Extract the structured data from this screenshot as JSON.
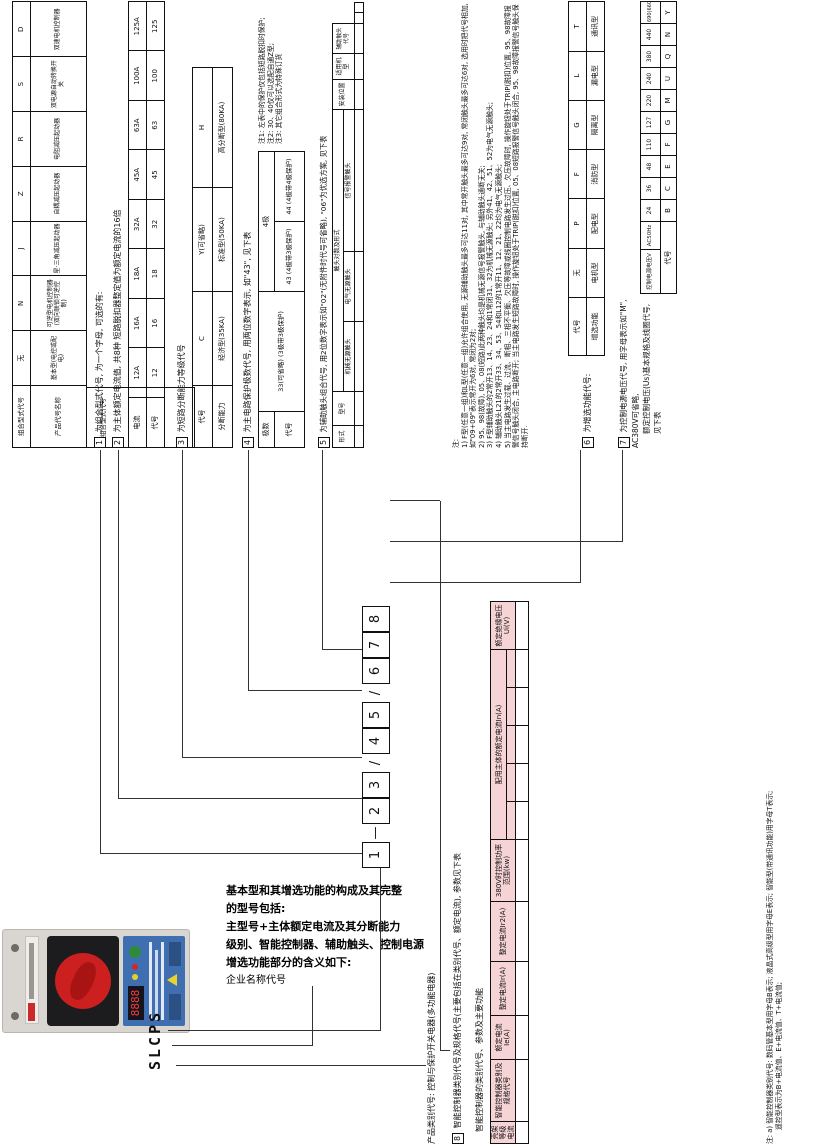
{
  "brand_model": "SLCPS",
  "intro": {
    "lines": [
      "基本型和其增选功能的构成及其完整",
      "的型号包括:",
      "主型号+主体额定电流及其分断能力",
      "级别、智能控制器、辅助触头、控制电源",
      "增选功能部分的含义如下:",
      "企业名称代号"
    ]
  },
  "model_row": {
    "items": [
      {
        "t": "1",
        "cls": "mbox"
      },
      {
        "t": "—",
        "cls": "msep"
      },
      {
        "t": "2",
        "cls": "mbox"
      },
      {
        "t": "3",
        "cls": "mbox"
      },
      {
        "t": "/",
        "cls": "msep"
      },
      {
        "t": "4",
        "cls": "mbox"
      },
      {
        "t": "5",
        "cls": "mbox"
      },
      {
        "t": "/",
        "cls": "msep"
      },
      {
        "t": "6",
        "cls": "mbox"
      },
      {
        "t": "7",
        "cls": "mbox"
      },
      {
        "t": "8",
        "cls": "mbox"
      }
    ]
  },
  "left_captions": {
    "product_class": "产品类别代号: 控制与保护开关电器(多功能电器)",
    "sec8_num": "8",
    "sec8_caption": "智能控制器类别代号及规格代号(主要包括在类别代号、额定电流), 参数见下表",
    "big_table_title": "智能控制器的类别代号、参数及主要功能"
  },
  "sections": {
    "s1": {
      "num": "1",
      "caption": "为组合型式代号, 为一个字母, 可选的有:",
      "row1_label": "组合型式代号",
      "row2_label": "产品代号名称",
      "codes": [
        "无",
        "N",
        "J",
        "Z",
        "R",
        "S",
        "D"
      ],
      "names": [
        "基本型(电控或配电)",
        "可逆型电机控制器(双向联锁可逆控制)",
        "星·三角减压起动器",
        "自耦减压起动器",
        "电阻减压起动器",
        "双电源自动转换开关",
        "双速电机控制器"
      ]
    },
    "s2": {
      "num": "2",
      "caption": "为主体额定电流值, 共8种 短路脱扣器整定值为额定电流的16倍",
      "row1_label": "电流",
      "row2_label": "代号",
      "currents": [
        "12A",
        "16A",
        "18A",
        "32A",
        "45A",
        "63A",
        "100A",
        "125A"
      ],
      "codes": [
        "12",
        "16",
        "18",
        "32",
        "45",
        "63",
        "100",
        "125"
      ]
    },
    "s3": {
      "num": "3",
      "caption": "为短路分断能力等级代号",
      "row1_label": "代号",
      "row2_label": "分断能力",
      "codes": [
        "C",
        "Y(可省略)",
        "H"
      ],
      "abilities": [
        "经济型(35KA)",
        "标准型(50KA)",
        "高分断型(80KA)"
      ]
    },
    "s4": {
      "num": "4",
      "caption": "为主电路保护极数代号, 用两位数字表示, 如\"43\", 见下表",
      "poles_label": "极数",
      "code_label": "代号",
      "cell_33": "33(可省略) (3极带3极保护)",
      "cell_4p": "4极",
      "cell_43": "43 (4极带3极保护)",
      "cell_44": "44 (4极带4极保护)",
      "notes": [
        "注1: 左表中的保护仅包括短路脱扣时保护;",
        "注2: 30、40仅可以选配自通Z型;",
        "注3: 其它组合形式为特殊订货"
      ]
    },
    "s5": {
      "num": "5",
      "caption": "为辅助触头组合代号, 用2位数字表示如\"02\"(无附件时代号可省略), \"06\"为优选方案, 见下表",
      "h_form": "形式",
      "h_model": "型号",
      "h_pairs": "触头对数及形式",
      "h_mech": "机械无源触头",
      "h_elec": "电气无源触头",
      "h_alarm": "信号报警触头",
      "h_pos": "安装位置",
      "h_apply": "适用机型",
      "h_code": "辅助触头代号",
      "rows": [
        {
          "cells": [
            {
              "t": "F型",
              "rs": 8
            },
            {
              "t": "F210"
            },
            {
              "t": "2常开+1常闭"
            },
            {
              "t": "—"
            },
            {
              "t": "—"
            },
            {
              "t": "右边",
              "rs": 8
            },
            {
              "t": "全系列产品",
              "rs": 10
            },
            {
              "t": "01"
            }
          ]
        },
        {
          "cells": [
            {
              "t": "F212"
            },
            {
              "t": "2常开+1常闭"
            },
            {
              "t": "—"
            },
            {
              "t": "1常开(故障)+1常开(短路)"
            },
            {
              "t": "02"
            }
          ]
        },
        {
          "cells": [
            {
              "t": "F212b"
            },
            {
              "t": "2常开+1常闭"
            },
            {
              "t": "—"
            },
            {
              "t": "1常开(故障)+1常开(等待)"
            },
            {
              "t": "03"
            }
          ]
        },
        {
          "cells": [
            {
              "t": "F212c"
            },
            {
              "t": "2常开+1常闭"
            },
            {
              "t": "—"
            },
            {
              "t": "1常开(等待)+1常开(短路)"
            },
            {
              "t": "04"
            }
          ]
        },
        {
          "cells": [
            {
              "t": "F330"
            },
            {
              "t": "2常开+1常闭"
            },
            {
              "t": "—"
            },
            {
              "t": "—"
            },
            {
              "t": "05"
            }
          ]
        },
        {
          "cells": [
            {
              "t": "F332"
            },
            {
              "t": "2常开+1常闭"
            },
            {
              "t": "1常开+2常闭"
            },
            {
              "t": "1常开(故障)+1常开(短路)"
            },
            {
              "t": "06"
            }
          ]
        },
        {
          "cells": [
            {
              "t": "F332b"
            },
            {
              "t": "2常开+1常闭"
            },
            {
              "t": "1常开+2常闭"
            },
            {
              "t": "1常开(故障)+1常开(等待)"
            },
            {
              "t": "07"
            }
          ]
        },
        {
          "cells": [
            {
              "t": "F332c"
            },
            {
              "t": "2常开+1常闭"
            },
            {
              "t": "1常开+2常闭"
            },
            {
              "t": "1常开(等待)+1常开(短路)"
            },
            {
              "t": "08"
            }
          ]
        },
        {
          "cells": [
            {
              "t": "L型",
              "rs": 2
            },
            {
              "t": "L21"
            },
            {
              "t": "2常开+1常闭"
            },
            {
              "t": "—"
            },
            {
              "t": "—"
            },
            {
              "t": "左边",
              "rs": 2
            },
            {
              "t": "09"
            }
          ]
        },
        {
          "cells": [
            {
              "t": "L12"
            },
            {
              "t": "1常开+2常闭"
            },
            {
              "t": "—"
            },
            {
              "t": "—"
            },
            {
              "t": "00"
            }
          ]
        }
      ]
    },
    "notes_block": {
      "title": "注:",
      "items": [
        "1) F型(任意一组)和L型(任意一组)允许组合使用, 无源辅助触头最多可达11对, 其中常开触头最多可达9对, 常闭触头最多可达6对, 选用时把代号相加, 如\"09+09\"表示常开为6对, 常闭为2对;",
        "2) 95、98(故障), 05、08(短路)此两种触头均是机械无源信号报警触头, 与辅助触头通断无关;",
        "3) F型辅助触头的2常开13、14、23、24和1常闭31、32为机械无源触头; 另外41、42、51、52为电气无源触头;",
        "4) 辅助触头L21的2常开33、34、53、54和L12的1常开11、12、21、22均为电气无源触头;",
        "5) 当主电路发生过载、过流、断相、三相不平衡、欠压等故障或线圈控制电路发生过压、欠压故障时, 操作旋钮处于TRIP(脱扣)位置, 95、98故障报警信号触头闭合, 主电路断开; 当主电路发生短路故障时, 操作旋钮处于TRIP(脱扣)位置, 05、08短路报警信号触头闭合, 95、98故障报警信号触头保持断开."
      ]
    },
    "s6": {
      "num": "6",
      "caption": "为增选功能代号:",
      "row1_label": "代号",
      "row2_label": "增选功能",
      "codes": [
        "无",
        "P",
        "F",
        "G",
        "L",
        "T"
      ],
      "functions": [
        "电机型",
        "配电型",
        "消防型",
        "隔离型",
        "漏电型",
        "通讯型"
      ]
    },
    "s7": {
      "num": "7",
      "caption_line1": "为控制电源电压代号, 用字母表示如\"M\", AC380V可省略,",
      "caption_line2": "额定控制电压(Us)基本规格及线圈代号, 见下表",
      "row1_label": "控制电源电压V",
      "row1_sub": "AC50Hz",
      "row2_label": "代号",
      "voltages": [
        "24",
        "36",
        "48",
        "110",
        "127",
        "220",
        "240",
        "380",
        "440",
        "690(660)"
      ],
      "codes": [
        "B",
        "C",
        "E",
        "F",
        "G",
        "M",
        "U",
        "Q",
        "N",
        "Y"
      ]
    }
  },
  "big_table": {
    "header_row1": [
      {
        "t": "壳架等级电流",
        "rs": 2,
        "cls": "pk"
      },
      {
        "t": "智能控制器类别及规格代号",
        "rs": 2,
        "cls": "pk"
      },
      {
        "t": "额定电流Ie(A)",
        "rs": 2,
        "cls": "pk"
      },
      {
        "t": "整定电流Ir(A)",
        "rs": 2,
        "cls": "pk"
      },
      {
        "t": "整定电流Ir2(A)",
        "rs": 2,
        "cls": "pk"
      },
      {
        "t": "380V时控制功率范围(kw)",
        "rs": 2,
        "cls": "pk"
      },
      {
        "t": "配用主体的额定电流In(A)",
        "cs": 5,
        "cls": "pk"
      },
      {
        "t": "额定绝缘电压Ui(V)",
        "rs": 2,
        "cls": "pk"
      }
    ],
    "header_row2": [
      {
        "t": "",
        "cls": "pk"
      },
      {
        "t": "",
        "cls": "pk"
      },
      {
        "t": "",
        "cls": "pk"
      },
      {
        "t": "",
        "cls": "pk"
      },
      {
        "t": "",
        "cls": "pk"
      }
    ],
    "rows": [
      {
        "cells": [
          {
            "t": "45A",
            "rs": 11,
            "cls": "vtwrap"
          },
          {
            "t": "□0.4"
          },
          {
            "t": "0.4"
          },
          {
            "t": "0.16-0.4"
          },
          {
            "t": "2.4-4.8"
          },
          {
            "t": "0.05-0.12"
          },
          {
            "t": "12",
            "rs": 5,
            "cls": "big"
          },
          {
            "t": "",
            "rs": 5,
            "cs": 4,
            "cls": "hx"
          },
          {
            "t": "690",
            "rs": 11
          }
        ]
      },
      {
        "cells": [
          {
            "t": "□1"
          },
          {
            "t": "1"
          },
          {
            "t": "0.4-1"
          },
          {
            "t": "6-12"
          },
          {
            "t": "0.12-0.33"
          }
        ]
      },
      {
        "cells": [
          {
            "t": "□2.5"
          },
          {
            "t": "2.5"
          },
          {
            "t": "1-2.5"
          },
          {
            "t": "15-40"
          },
          {
            "t": "0.33-1"
          }
        ]
      },
      {
        "cells": [
          {
            "t": "□6.3"
          },
          {
            "t": "6.3"
          },
          {
            "t": "2.5-6.3"
          },
          {
            "t": "37.8-75.6"
          },
          {
            "t": "1-3"
          }
        ]
      },
      {
        "cells": [
          {
            "t": "□12"
          },
          {
            "t": "12"
          },
          {
            "t": "4.8-12"
          },
          {
            "t": "72-144"
          },
          {
            "t": "2.2-5.5"
          }
        ]
      },
      {
        "cells": [
          {
            "t": "□16"
          },
          {
            "t": "16"
          },
          {
            "t": "6.4-16"
          },
          {
            "t": "96-192"
          },
          {
            "t": "2.5-7.5"
          },
          {
            "t": "",
            "rs": 6,
            "cls": "hx"
          },
          {
            "t": "16",
            "cls": "big"
          },
          {
            "t": "",
            "cs": 3,
            "cls": "hx"
          }
        ]
      },
      {
        "cells": [
          {
            "t": "□18"
          },
          {
            "t": "18"
          },
          {
            "t": "7.2-18"
          },
          {
            "t": "108-216"
          },
          {
            "t": "3.3-8"
          },
          {
            "t": "",
            "rs": 5,
            "cls": "hx"
          },
          {
            "t": "18",
            "cls": "big"
          },
          {
            "t": "",
            "cs": 2,
            "cls": "hx"
          }
        ]
      },
      {
        "cells": [
          {
            "t": "□32"
          },
          {
            "t": "32"
          },
          {
            "t": "12.8-32"
          },
          {
            "t": "192-384"
          },
          {
            "t": "5.5-15"
          },
          {
            "t": "",
            "rs": 4,
            "cls": "hx"
          },
          {
            "t": "32",
            "cls": "big"
          },
          {
            "t": "",
            "cls": "hx"
          }
        ]
      },
      {
        "cells": [
          {
            "t": "□45"
          },
          {
            "t": "45"
          },
          {
            "t": "18-45"
          },
          {
            "t": "270-540"
          },
          {
            "t": "7.5-22"
          },
          {
            "t": "",
            "rs": 3,
            "cls": "hx"
          },
          {
            "t": "45",
            "rs": 3,
            "cls": "big"
          }
        ]
      },
      {
        "cells": [
          {
            "t": "□50"
          },
          {
            "t": "50"
          },
          {
            "t": "20-50"
          },
          {
            "t": "300-600"
          },
          {
            "t": "7.5-22.5"
          }
        ]
      },
      {
        "cells": [
          {
            "t": "□63"
          },
          {
            "t": "63"
          },
          {
            "t": "25-63"
          },
          {
            "t": "378-756"
          },
          {
            "t": "11-30"
          }
        ]
      },
      {
        "cells": [
          {
            "t": "125A",
            "rs": 4,
            "cls": "vtwrap"
          },
          {
            "t": "□45"
          },
          {
            "t": "45"
          },
          {
            "t": "18-45"
          },
          {
            "t": "270-540"
          },
          {
            "t": "7.5-22"
          },
          {
            "t": "45",
            "cs": 5,
            "cls": "big"
          },
          {
            "t": "690",
            "rs": 4
          }
        ]
      },
      {
        "cells": [
          {
            "t": "□63"
          },
          {
            "t": "63"
          },
          {
            "t": "45-63"
          },
          {
            "t": "378-756"
          },
          {
            "t": "11-30"
          },
          {
            "t": "63",
            "cs": 5,
            "cls": "big"
          }
        ]
      },
      {
        "cells": [
          {
            "t": "□100"
          },
          {
            "t": "100"
          },
          {
            "t": "40-100"
          },
          {
            "t": "600-1200"
          },
          {
            "t": "18.5-45"
          },
          {
            "t": "100",
            "cs": 5,
            "cls": "big"
          }
        ]
      },
      {
        "cells": [
          {
            "t": "□125"
          },
          {
            "t": "125"
          },
          {
            "t": "50-125"
          },
          {
            "t": "750-1500"
          },
          {
            "t": "22-50"
          },
          {
            "t": "125",
            "cs": 5,
            "cls": "big"
          }
        ]
      },
      {
        "cells": [
          {
            "t": "全系列"
          },
          {
            "t": "Z"
          },
          {
            "t": "Z"
          },
          {
            "t": "无保护(除短路保护)",
            "cs": 3
          },
          {
            "t": "全电流",
            "cs": 5
          },
          {
            "t": "690"
          }
        ]
      }
    ],
    "bottom_note_line1": "注: a) 智能控制器类别代号: 数码管基本型用字母B表示; 液晶式高级型用字母E表示; 智能型(带通讯功能)用字母T表示;",
    "bottom_note_line2": "遥控型表示为B+电流值、E+电流值、T+电流值;"
  },
  "photo": {
    "display_digits": "8888",
    "accent_red": "#cc1f1f",
    "panel_blue": "#3f6fb0",
    "body_gray": "#d9d6d2"
  }
}
